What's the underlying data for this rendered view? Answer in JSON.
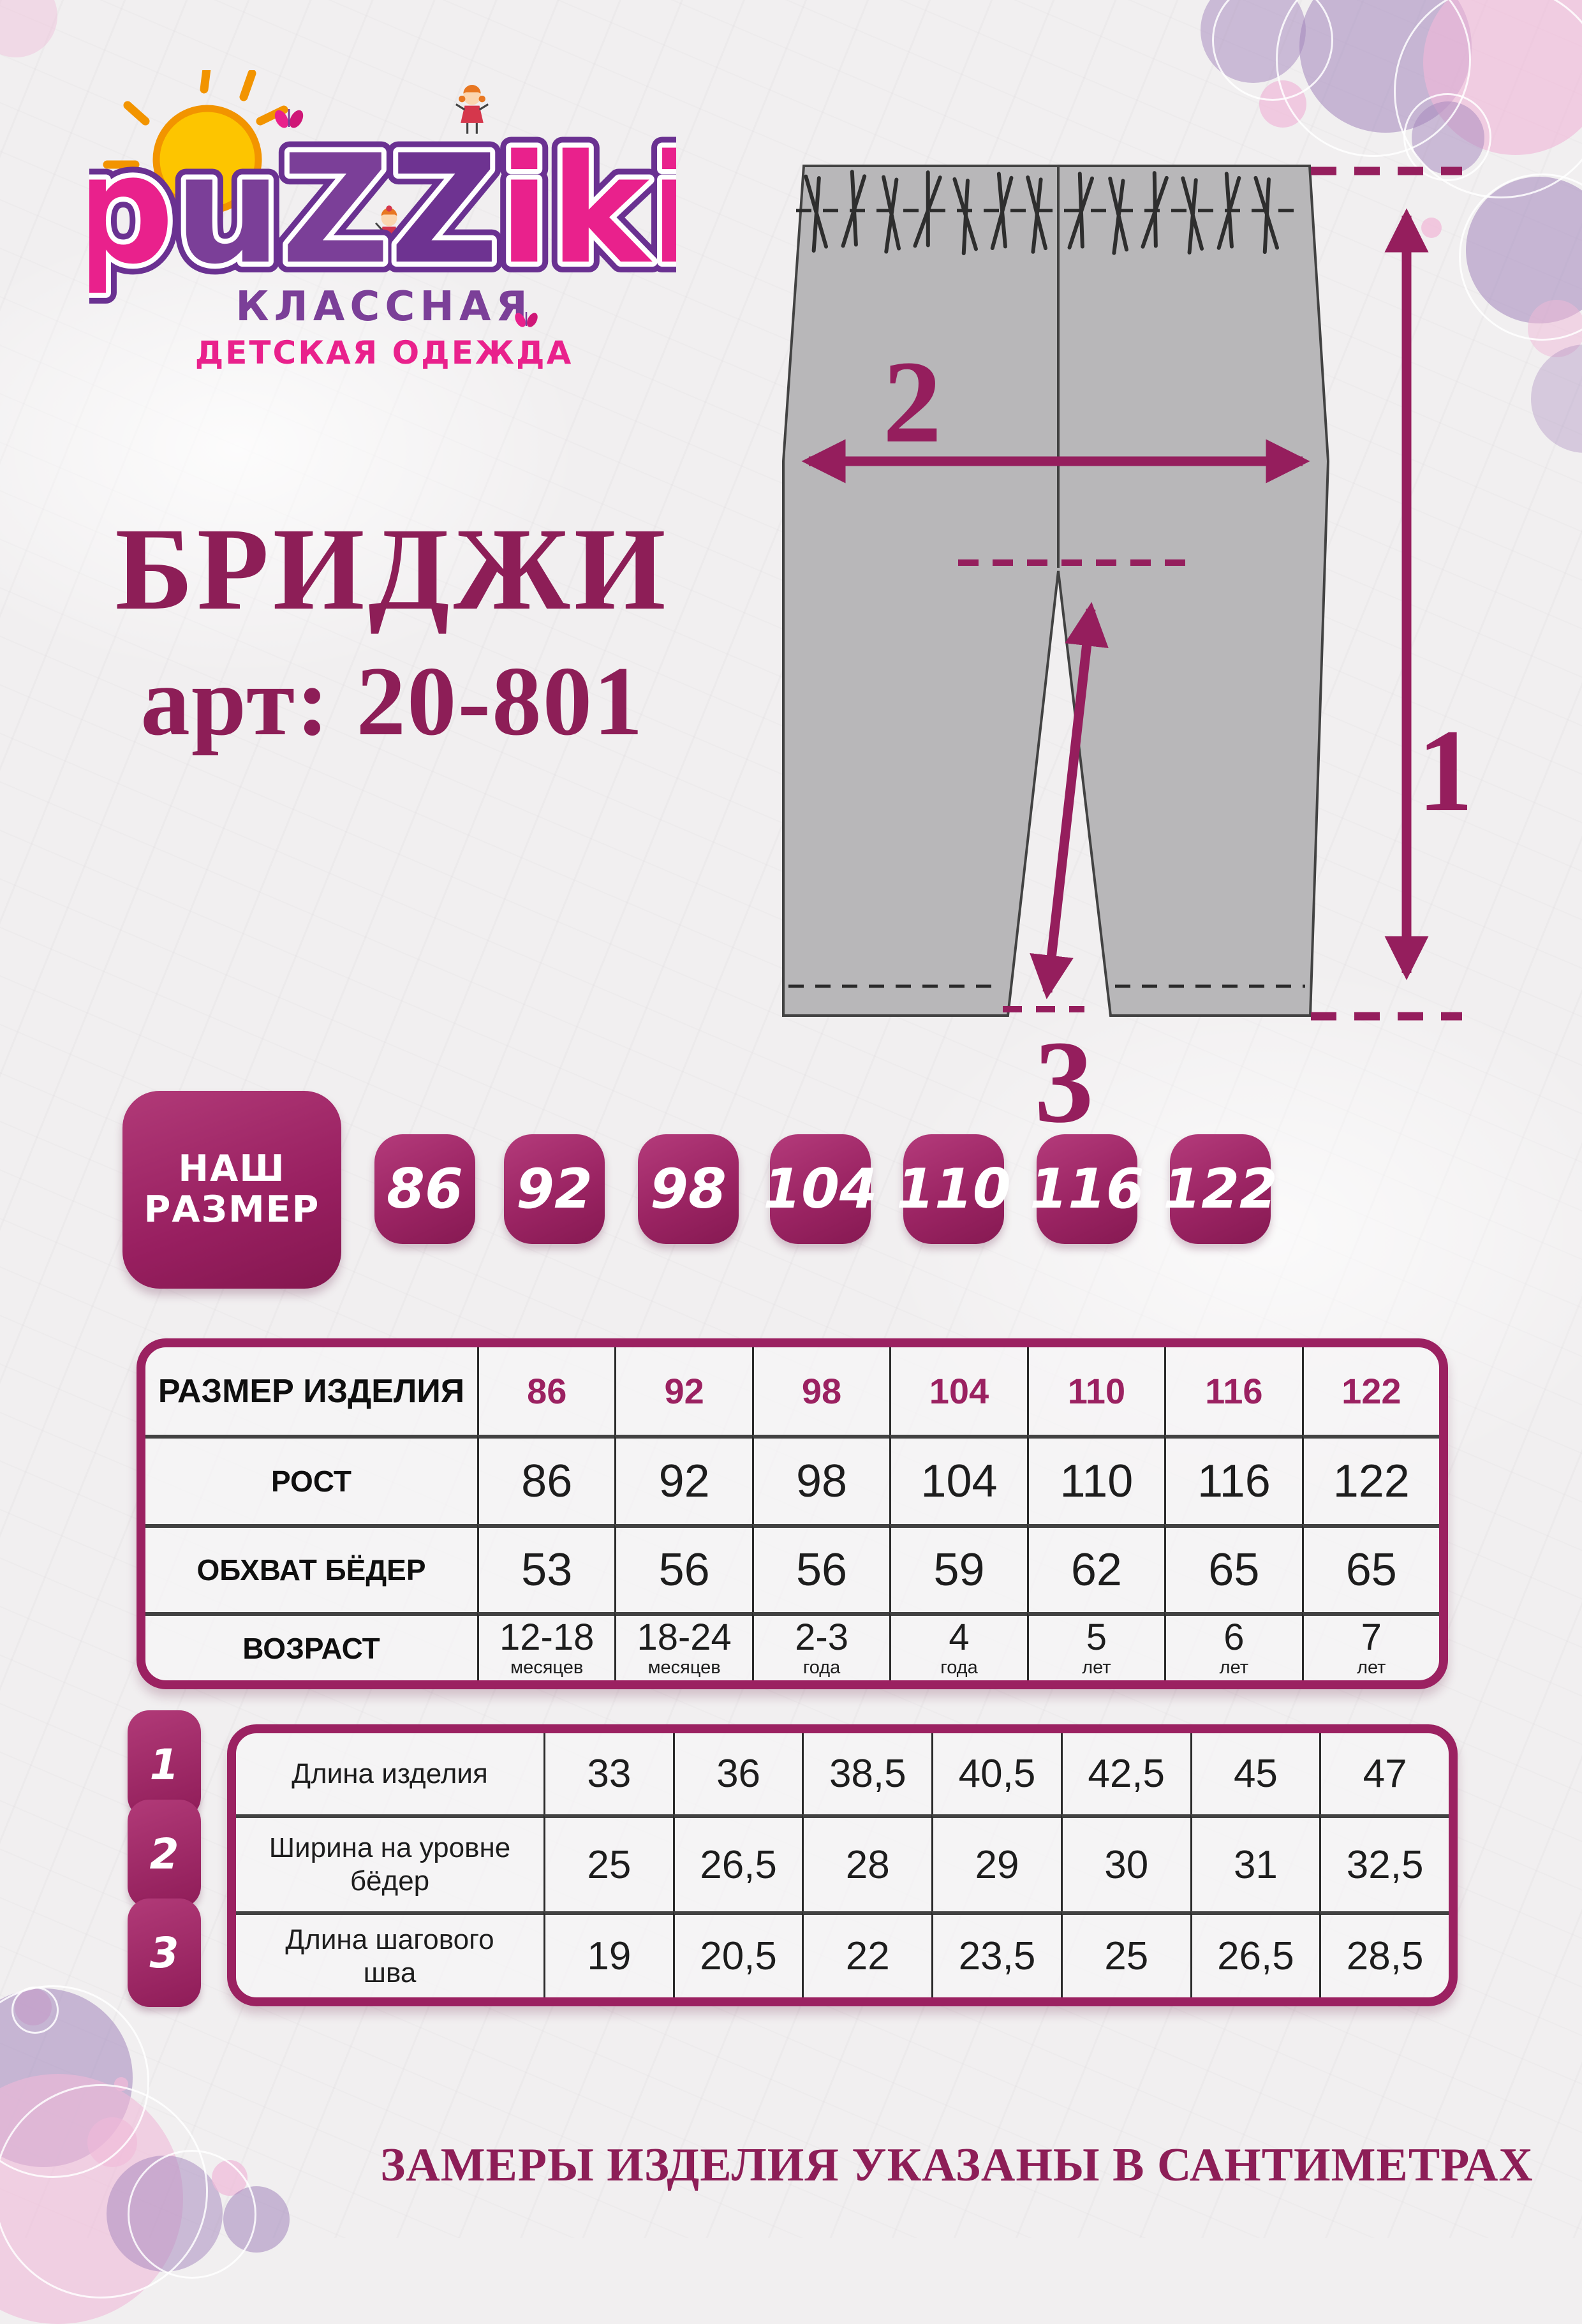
{
  "brand": {
    "name_letters": [
      "p",
      "u",
      "Z",
      "Z",
      "i",
      "k",
      "i"
    ],
    "tagline_line1": "КЛАССНАЯ",
    "tagline_line2": "ДЕТСКАЯ ОДЕЖДА"
  },
  "product": {
    "title": "БРИДЖИ",
    "article": "арт: 20-801"
  },
  "diagram": {
    "label_length": "1",
    "label_width": "2",
    "label_inseam": "3"
  },
  "size_selector": {
    "label_line1": "НАШ",
    "label_line2": "РАЗМЕР",
    "sizes": [
      "86",
      "92",
      "98",
      "104",
      "110",
      "116",
      "122"
    ]
  },
  "size_table": {
    "header_label": "РАЗМЕР ИЗДЕЛИЯ",
    "sizes": [
      "86",
      "92",
      "98",
      "104",
      "110",
      "116",
      "122"
    ],
    "rost_label": "РОСТ",
    "rost": [
      "86",
      "92",
      "98",
      "104",
      "110",
      "116",
      "122"
    ],
    "hips_label": "ОБХВАТ БЁДЕР",
    "hips": [
      "53",
      "56",
      "56",
      "59",
      "62",
      "65",
      "65"
    ],
    "age_label": "ВОЗРАСТ",
    "age": [
      {
        "v": "12-18",
        "u": "месяцев"
      },
      {
        "v": "18-24",
        "u": "месяцев"
      },
      {
        "v": "2-3",
        "u": "года"
      },
      {
        "v": "4",
        "u": "года"
      },
      {
        "v": "5",
        "u": "лет"
      },
      {
        "v": "6",
        "u": "лет"
      },
      {
        "v": "7",
        "u": "лет"
      }
    ]
  },
  "measure_table": {
    "rows": [
      {
        "num": "1",
        "label": "Длина изделия",
        "values": [
          "33",
          "36",
          "38,5",
          "40,5",
          "42,5",
          "45",
          "47"
        ]
      },
      {
        "num": "2",
        "label": "Ширина на уровне бёдер",
        "values": [
          "25",
          "26,5",
          "28",
          "29",
          "30",
          "31",
          "32,5"
        ]
      },
      {
        "num": "3",
        "label": "Длина шагового шва",
        "values": [
          "19",
          "20,5",
          "22",
          "23,5",
          "25",
          "26,5",
          "28,5"
        ]
      }
    ]
  },
  "footer": {
    "note": "ЗАМЕРЫ ИЗДЕЛИЯ УКАЗАНЫ В САНТИМЕТРАХ"
  },
  "colors": {
    "magenta": "#9b2161",
    "pink": "#e9218c",
    "purple": "#7b3f98",
    "arrow": "#951e5d"
  }
}
